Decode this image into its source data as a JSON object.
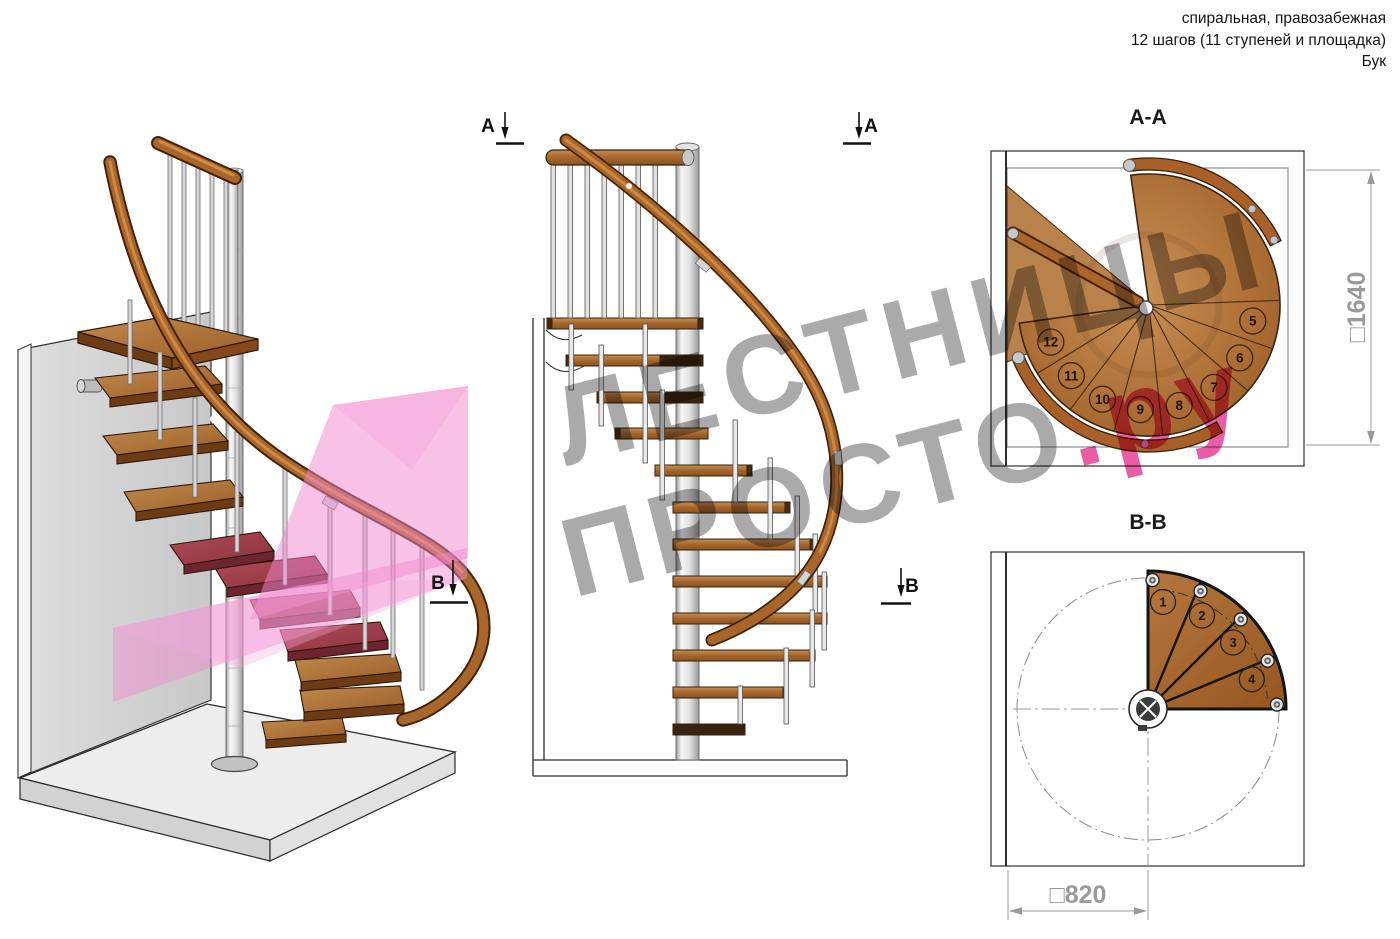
{
  "header": {
    "line1": "спиральная, правозабежная",
    "line2": "12 шагов (11 ступеней и площадка)",
    "line3": "Бук"
  },
  "views": {
    "plan_top": {
      "title": "А-А",
      "dimension": "□1640",
      "step_numbers": [
        "5",
        "6",
        "7",
        "8",
        "9",
        "10",
        "11",
        "12"
      ]
    },
    "plan_bottom": {
      "title": "В-В",
      "dimension": "□820",
      "step_numbers": [
        "1",
        "2",
        "3",
        "4"
      ]
    }
  },
  "markers": {
    "a": "А",
    "b": "В"
  },
  "watermark": {
    "line1": "ЛЕСТНИЦЫ",
    "line2_gray": "ПРОСТО",
    "line2_pink": ".ру"
  },
  "colors": {
    "wood_light": "#c08a4e",
    "wood_mid": "#a5662c",
    "wood_dark": "#45210a",
    "crimson_step": "#a8424e",
    "pink_plane": "#f285ce",
    "watermark_gray": "#979797",
    "watermark_pink": "#e63890",
    "dimension_gray": "#9a9a9a",
    "metal_gray": "#c9c9c9"
  }
}
